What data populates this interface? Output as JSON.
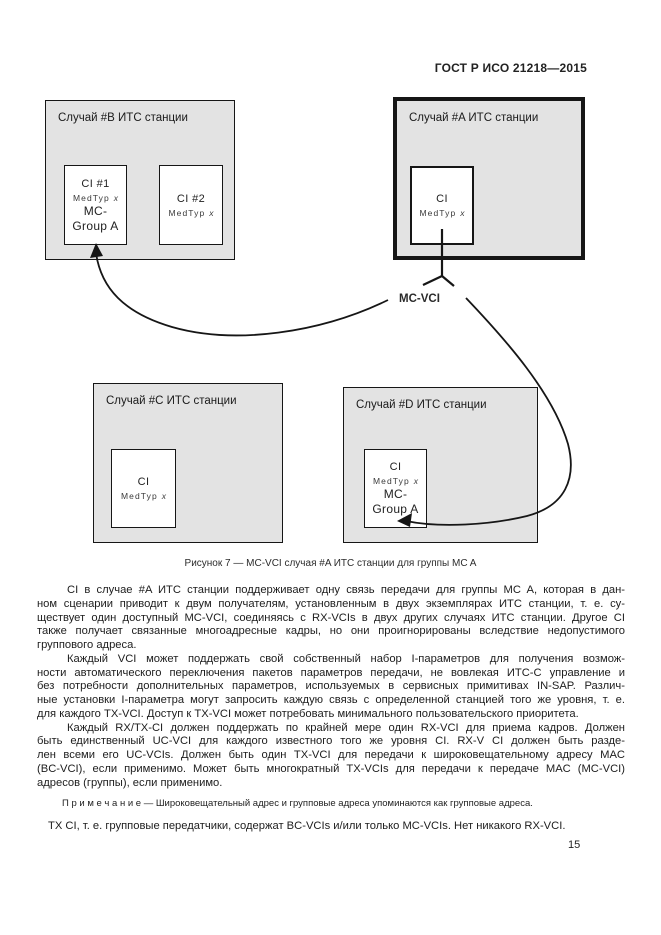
{
  "page": {
    "header": "ГОСТ Р ИСО 21218—2015",
    "number": "15"
  },
  "figure": {
    "caption": "Рисунок 7 — MC-VCI случая #A ИТС станции для группы MC A",
    "mc_vci_label": "MC-VCI",
    "stations": {
      "case_b": {
        "title": "Случай #B ИТС станции",
        "ci1": {
          "name": "CI #1",
          "med_label": "MedTyp",
          "med_var": "x",
          "group_line1": "MC-",
          "group_line2": "Group A"
        },
        "ci2": {
          "name": "CI #2",
          "med_label": "MedTyp",
          "med_var": "x"
        }
      },
      "case_a": {
        "title": "Случай #A ИТС станции",
        "ci": {
          "name": "CI",
          "med_label": "MedTyp",
          "med_var": "x"
        }
      },
      "case_c": {
        "title": "Случай #C ИТС станции",
        "ci": {
          "name": "CI",
          "med_label": "MedTyp",
          "med_var": "x"
        }
      },
      "case_d": {
        "title": "Случай #D ИТС станции",
        "ci": {
          "name": "CI",
          "med_label": "MedTyp",
          "med_var": "x",
          "group_line1": "MC-",
          "group_line2": "Group A"
        }
      }
    }
  },
  "body": {
    "paragraphs": [
      {
        "lines": [
          "CI в случае #A ИТС станции поддерживает одну связь передачи для группы MC A, которая в дан-",
          "ном сценарии приводит к двум получателям, установленным в двух экземплярах ИТС станции, т. е. су-",
          "ществует один доступный MC-VCI, соединяясь с RX-VCIs в двух других случаях ИТС станции. Другое CI",
          "также получает связанные многоадресные кадры, но они проигнорированы вследствие недопустимого",
          "группового адреса."
        ]
      },
      {
        "lines": [
          "Каждый VCI может поддержать свой собственный набор I-параметров для получения возмож-",
          "ности автоматического переключения пакетов параметров передачи, не вовлекая ИТС-С управление и",
          "без потребности дополнительных параметров, используемых в сервисных примитивах IN-SAP. Различ-",
          "ные установки I-параметра могут запросить каждую связь с определенной станцией того же уровня, т. е.",
          "для каждого TX-VCI. Доступ к TX-VCI может потребовать минимального пользовательского приоритета."
        ]
      },
      {
        "lines": [
          "Каждый RX/TX-CI должен поддержать по крайней мере один RX-VCI для приема кадров. Должен",
          "быть единственный UC-VCI для каждого известного того же уровня CI. RX-V CI должен быть разде-",
          "лен всеми его UC-VCIs. Должен быть один TX-VCI для передачи к широковещательному адресу MAC",
          "(BC-VCI), если применимо. Может быть многократный TX-VCIs для передачи к передаче MAC (MC-VCI)",
          "адресов (группы), если применимо."
        ]
      }
    ],
    "note": "П р и м е ч а н и е  —  Широковещательный адрес и групповые адреса упоминаются как групповые адреса.",
    "final_line": "TX CI, т. е. групповые передатчики, содержат BC-VCIs и/или только MC-VCIs. Нет никакого RX-VCI."
  },
  "colors": {
    "station_fill": "#e3e3e3",
    "line_color": "#161616"
  }
}
